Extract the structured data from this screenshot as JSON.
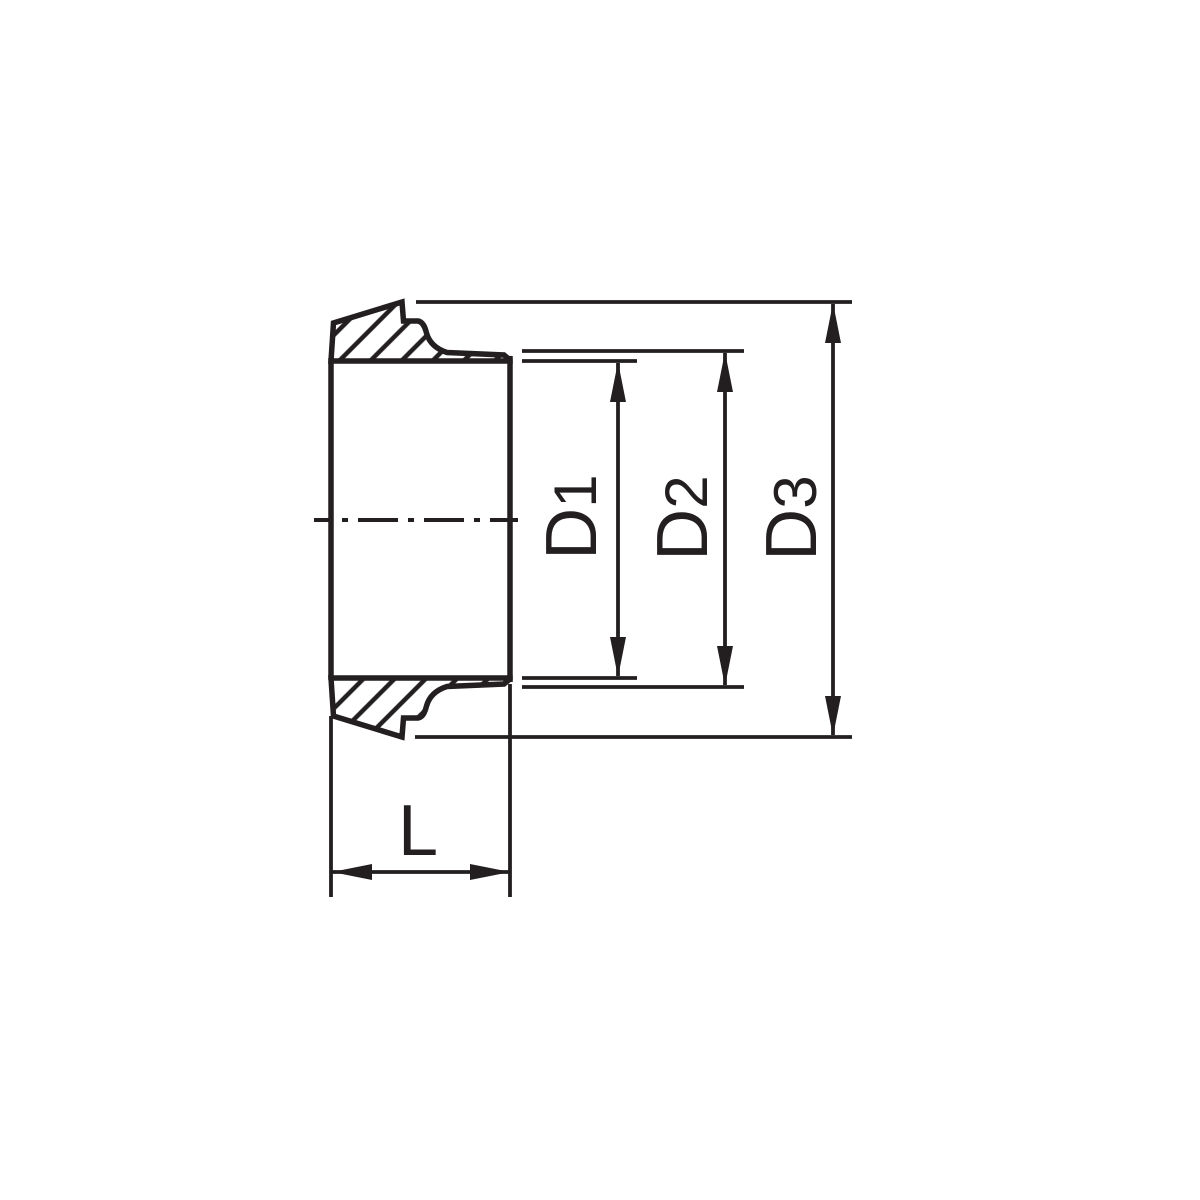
{
  "drawing": {
    "type": "technical-section-drawing",
    "background_color": "#ffffff",
    "line_color": "#231f20",
    "labels": {
      "d1": {
        "letter": "D",
        "sub": "1"
      },
      "d2": {
        "letter": "D",
        "sub": "2"
      },
      "d3": {
        "letter": "D",
        "sub": "3"
      },
      "length": {
        "letter": "L",
        "sub": ""
      }
    }
  }
}
